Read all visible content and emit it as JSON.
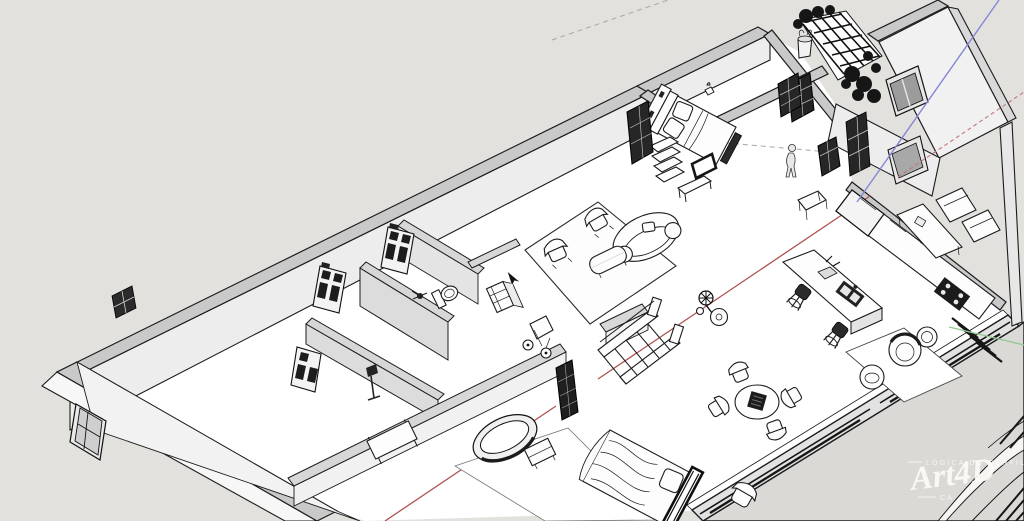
{
  "viewport": {
    "app": "3d-model-viewport",
    "description": "Bird's-eye cutaway 3D floor plan of a house, monochrome sketch render",
    "background_color": "#e3e1dd",
    "terrace_color": "#dad9d6",
    "wall_top_color": "#c9c9c9",
    "wall_face_color": "#ededed",
    "outline_color": "#1b1b1b"
  },
  "axes": {
    "red_axis_color": "#b05252",
    "green_axis_color": "#94c894",
    "blue_axis_color": "#8585d8",
    "red_axis_style": "solid through model, dotted beyond",
    "guide_line_color": "#a9a6a0"
  },
  "cursor": {
    "x": 508,
    "y": 277,
    "shape": "arrow"
  },
  "watermark": {
    "top_caption": "LÓGICA DO PERFIL",
    "script": "Art4D",
    "bottom_caption": "CA"
  },
  "rooms": [
    {
      "name": "master-bedroom",
      "items": [
        "double-bed",
        "pillows",
        "headboard-shelf",
        "foot-bench",
        "person-figure",
        "dark-wardrobe-doors",
        "corridor-door",
        "shelf-stack",
        "console-table",
        "floor-frame"
      ]
    },
    {
      "name": "living-room",
      "items": [
        "curved-sofa",
        "armchair",
        "armchair",
        "coffee-table",
        "area-rug",
        "pedestal-fan",
        "side-table"
      ]
    },
    {
      "name": "dining-area",
      "items": [
        "round-table",
        "dining-chair",
        "dining-chair",
        "dining-chair",
        "dining-chair",
        "dark-centerpiece"
      ]
    },
    {
      "name": "kitchen",
      "items": [
        "island-with-sink",
        "bar-stool",
        "bar-stool",
        "fridge",
        "back-counter",
        "cooktop",
        "peninsula-counter",
        "entry-steps",
        "hall-table"
      ]
    },
    {
      "name": "lounge-corner",
      "items": [
        "barrel-chair",
        "drum-table",
        "pouf",
        "rug"
      ]
    },
    {
      "name": "bathroom",
      "items": [
        "toilet",
        "vanity-cabinet",
        "shower-head",
        "utility-cart"
      ]
    },
    {
      "name": "second-bedroom",
      "items": [
        "bed-with-duvet",
        "dark-headboard",
        "oval-bathtub",
        "nightstand",
        "rug",
        "dark-entry-door",
        "side-chair"
      ]
    },
    {
      "name": "corner-room",
      "items": [
        "console-table",
        "floor-lamp",
        "open-door",
        "window"
      ]
    },
    {
      "name": "hall-and-stairs",
      "items": [
        "staircase-with-railing",
        "dark-glazed-door",
        "dark-glazed-door"
      ]
    },
    {
      "name": "exterior",
      "items": [
        "trellis-with-vines",
        "potted-plant",
        "gray-window",
        "gray-window",
        "utility-boxes",
        "terrace",
        "sliding-door-tracks",
        "leaning-door-panel",
        "leaning-door-panel",
        "small-window"
      ]
    }
  ]
}
